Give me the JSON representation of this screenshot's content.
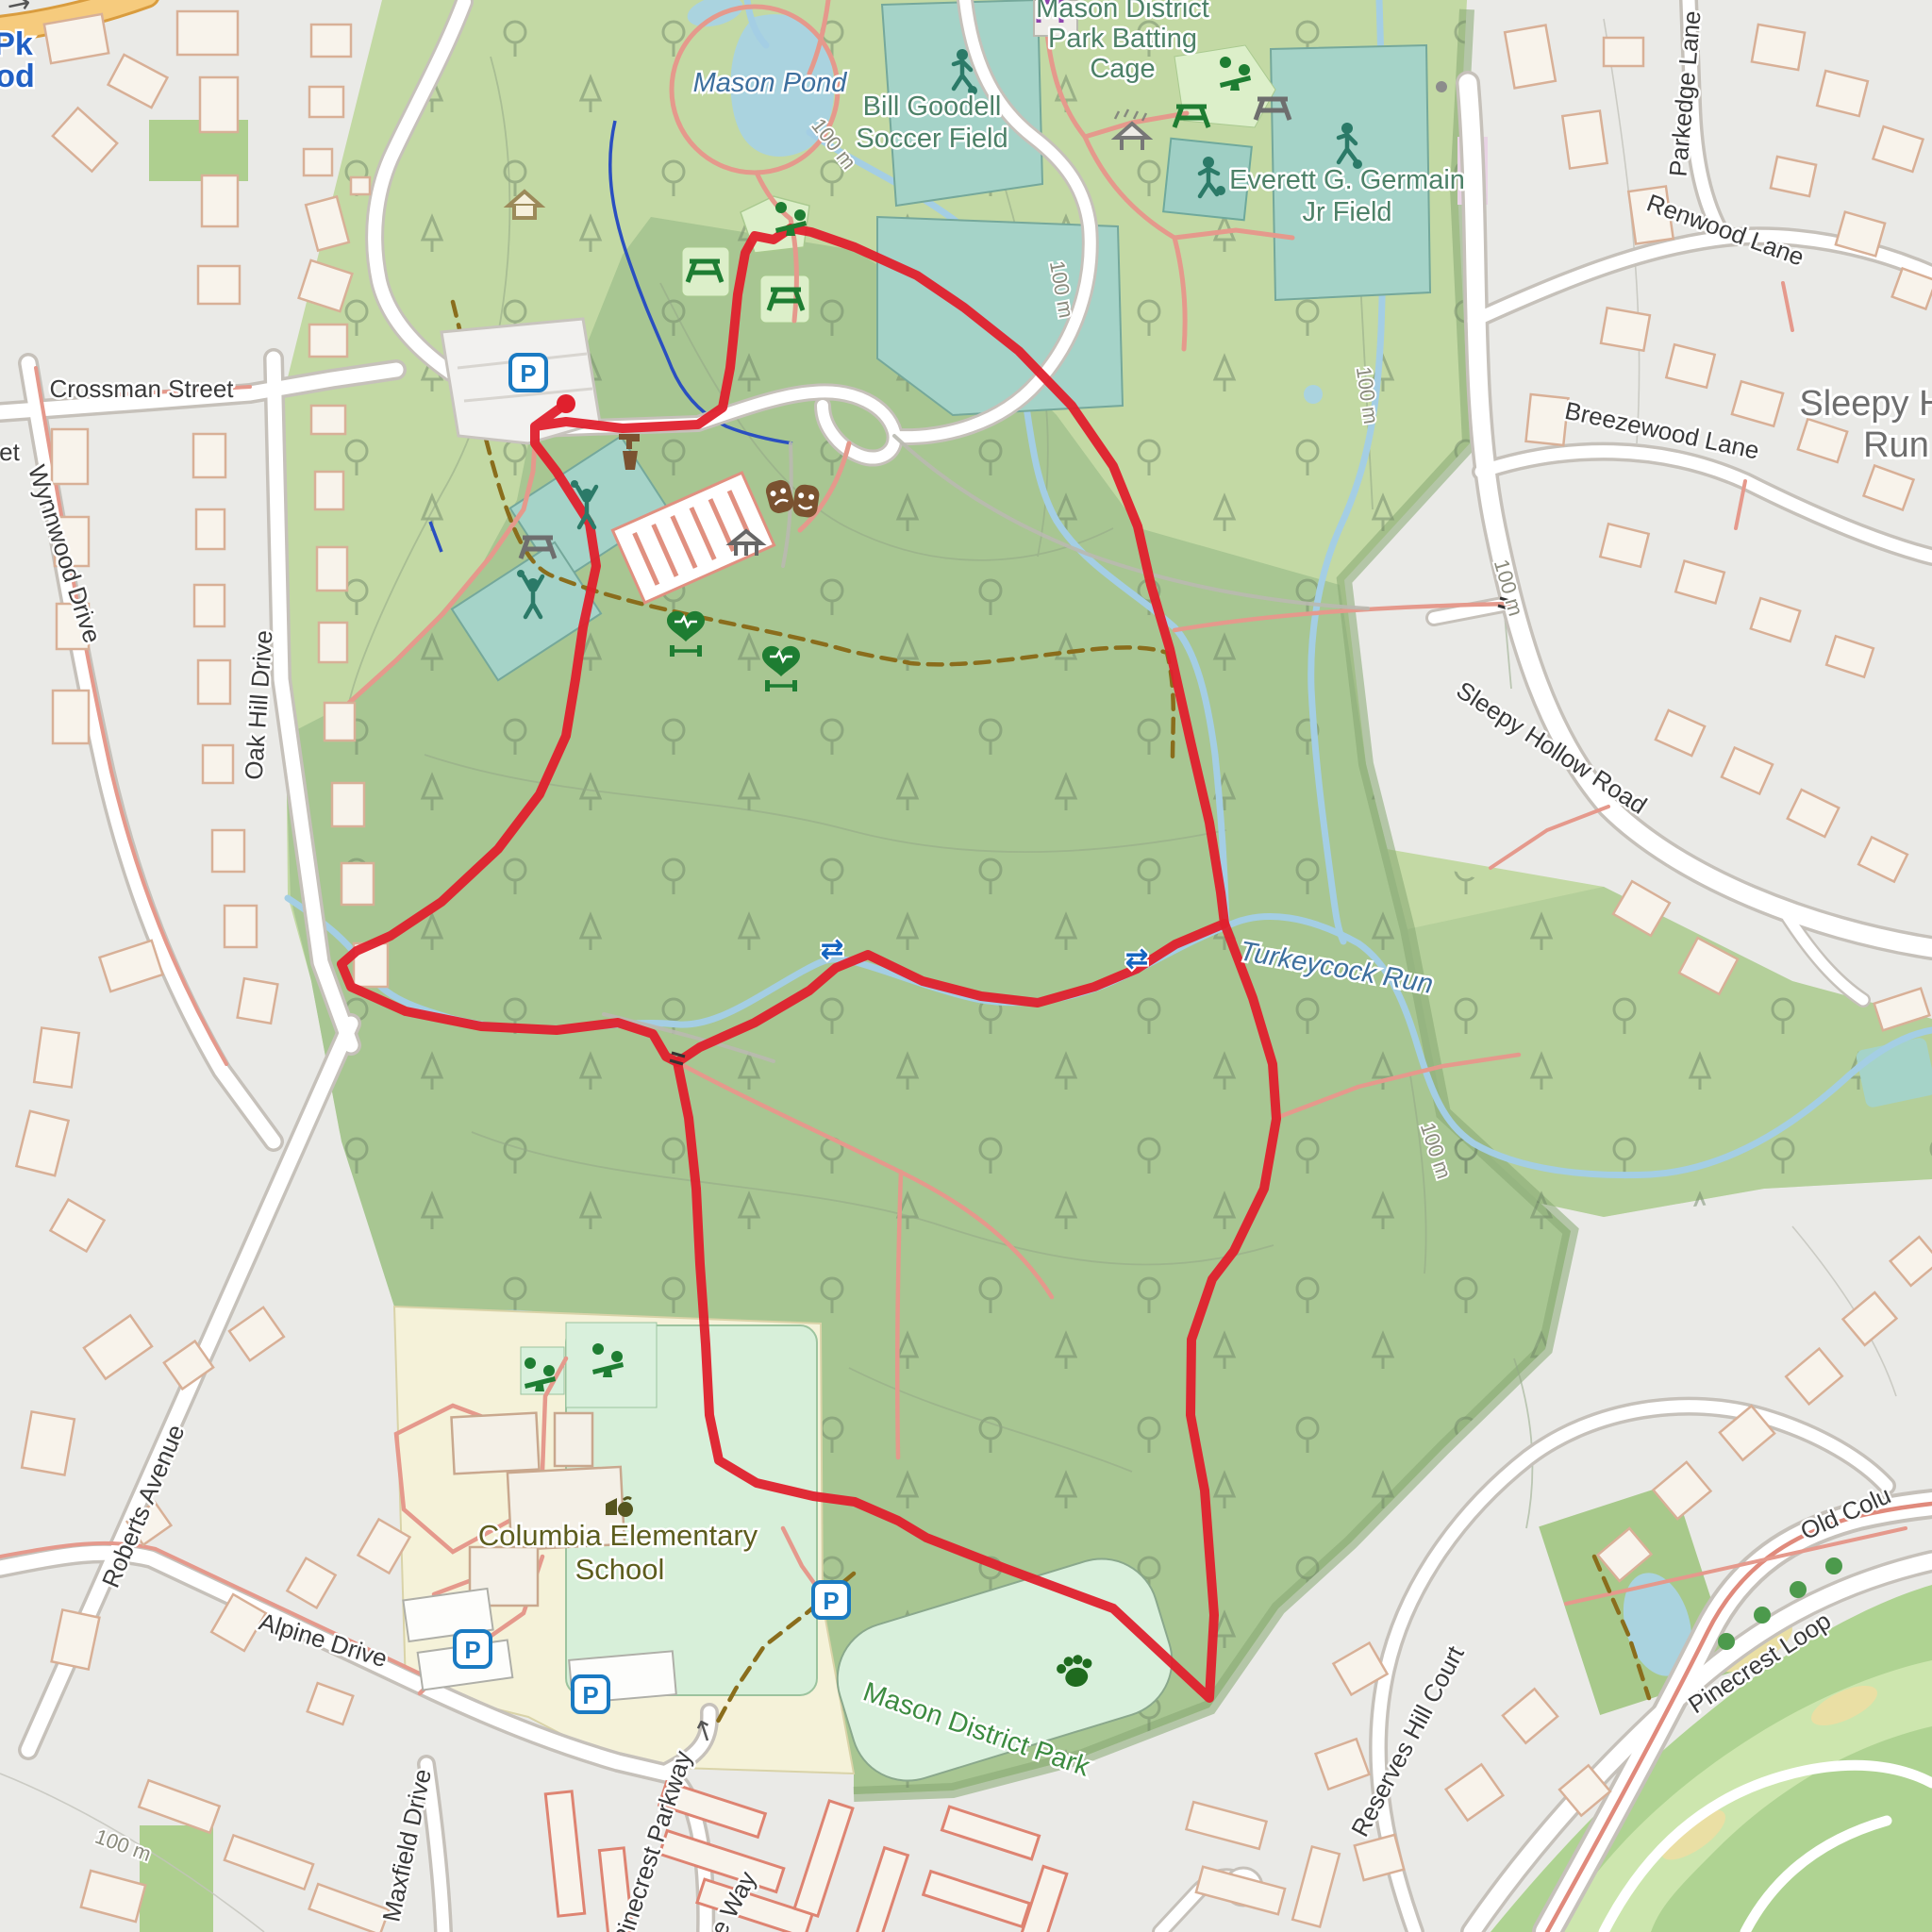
{
  "map_type": "openstreetmap-style park map with GPS route overlay",
  "colors": {
    "route": "#E0202D",
    "water": "#AAD3DF",
    "stream": "#A4CEE4",
    "park_light": "#C3D9A4",
    "forest": "#A8C692",
    "boundary_band": "#86A873",
    "sport_field": "#A5D3C8",
    "mint_field": "#D9F0DC",
    "school_ground": "#F5F2D9",
    "golf": "#AFD392",
    "urban": "#EAEAE7",
    "building_fill": "#F8F3EB",
    "building_outline": "#D8B097",
    "service_road": "#E5998C",
    "trail_dashed": "#8A6D1C",
    "parking_blue": "#1A7AC2",
    "icon_green": "#1E7D32",
    "icon_teal": "#2b7a68",
    "icon_brown": "#71522d",
    "icon_purple": "#8e44ad"
  },
  "labels": {
    "streets": [
      {
        "text": "Crossman Street"
      },
      {
        "text": "Wynnwood Drive"
      },
      {
        "text": "Oak Hill Drive"
      },
      {
        "text": "Roberts Avenue"
      },
      {
        "text": "Alpine Drive"
      },
      {
        "text": "Maxfield Drive"
      },
      {
        "text": "Pinecrest Parkway"
      },
      {
        "text": "Parkedge Lane"
      },
      {
        "text": "Renwood Lane"
      },
      {
        "text": "Breezewood Lane"
      },
      {
        "text": "Sleepy Hollow Road"
      },
      {
        "text": "Reserves Hill Court"
      },
      {
        "text": "Pinecrest Loop"
      },
      {
        "text": "Old Colu"
      },
      {
        "text": "e Way"
      },
      {
        "text": "et"
      }
    ],
    "places": {
      "pond": "Mason Pond",
      "turkeycock": "Turkeycock Run",
      "bill1": "Bill Goodell",
      "bill2": "Soccer Field",
      "batting1": "Mason District",
      "batting2": "Park Batting",
      "batting3": "Cage",
      "germain1": "Everett G. Germain",
      "germain2": "Jr Field",
      "school1": "Columbia Elementary",
      "school2": "School",
      "park": "Mason District Park",
      "sleepy1": "Sleepy Ho",
      "sleepy2": "Run",
      "pk": "Pk",
      "od": "od"
    },
    "contour": "100 m"
  },
  "glyphs": {
    "parking": "P",
    "oneway": "↑",
    "ford": "⇄",
    "orange_road_arrow": "→"
  },
  "route": {
    "color": "#E0202D",
    "start": [
      600,
      428
    ],
    "segments": [
      [
        [
          600,
          428
        ],
        [
          567,
          452
        ],
        [
          567,
          470
        ],
        [
          590,
          500
        ],
        [
          625,
          555
        ],
        [
          632,
          600
        ],
        [
          618,
          665
        ],
        [
          610,
          720
        ],
        [
          600,
          780
        ],
        [
          572,
          842
        ],
        [
          528,
          900
        ],
        [
          468,
          956
        ],
        [
          414,
          992
        ],
        [
          378,
          1008
        ],
        [
          362,
          1022
        ],
        [
          372,
          1046
        ],
        [
          430,
          1072
        ],
        [
          510,
          1088
        ],
        [
          590,
          1092
        ],
        [
          655,
          1084
        ],
        [
          692,
          1096
        ],
        [
          706,
          1120
        ],
        [
          718,
          1126
        ],
        [
          742,
          1110
        ],
        [
          800,
          1084
        ],
        [
          858,
          1050
        ],
        [
          886,
          1026
        ],
        [
          920,
          1012
        ],
        [
          978,
          1040
        ],
        [
          1040,
          1056
        ],
        [
          1100,
          1063
        ],
        [
          1160,
          1046
        ],
        [
          1205,
          1027
        ],
        [
          1246,
          1001
        ],
        [
          1298,
          979
        ],
        [
          1294,
          946
        ],
        [
          1282,
          872
        ],
        [
          1262,
          786
        ],
        [
          1240,
          688
        ],
        [
          1220,
          620
        ],
        [
          1206,
          558
        ],
        [
          1180,
          494
        ],
        [
          1136,
          430
        ],
        [
          1080,
          372
        ],
        [
          1022,
          326
        ],
        [
          972,
          292
        ],
        [
          906,
          262
        ],
        [
          860,
          246
        ],
        [
          838,
          242
        ],
        [
          820,
          254
        ],
        [
          800,
          250
        ],
        [
          790,
          268
        ],
        [
          782,
          312
        ],
        [
          777,
          362
        ],
        [
          774,
          390
        ],
        [
          766,
          432
        ],
        [
          740,
          450
        ],
        [
          660,
          454
        ],
        [
          600,
          447
        ],
        [
          567,
          452
        ]
      ],
      [
        [
          718,
          1126
        ],
        [
          730,
          1185
        ],
        [
          738,
          1260
        ],
        [
          742,
          1340
        ],
        [
          748,
          1425
        ],
        [
          752,
          1500
        ],
        [
          762,
          1548
        ],
        [
          802,
          1572
        ],
        [
          862,
          1586
        ],
        [
          906,
          1592
        ],
        [
          952,
          1612
        ],
        [
          982,
          1630
        ],
        [
          1064,
          1662
        ],
        [
          1180,
          1705
        ],
        [
          1282,
          1800
        ],
        [
          1287,
          1712
        ],
        [
          1277,
          1580
        ],
        [
          1262,
          1500
        ],
        [
          1263,
          1420
        ],
        [
          1285,
          1356
        ],
        [
          1308,
          1326
        ],
        [
          1340,
          1260
        ],
        [
          1353,
          1186
        ],
        [
          1349,
          1128
        ],
        [
          1328,
          1058
        ],
        [
          1298,
          979
        ]
      ]
    ]
  }
}
